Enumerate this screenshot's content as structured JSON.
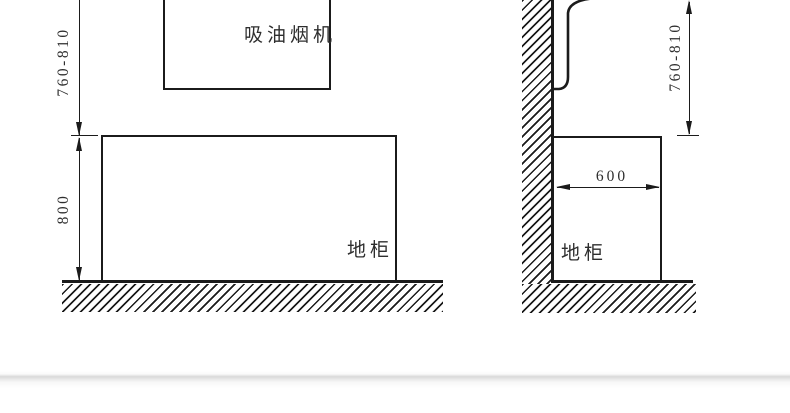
{
  "page": {
    "background_color": "#ffffff",
    "has_bottom_shadow_divider": true
  },
  "diagram": {
    "type": "installation-dimension-diagram",
    "line_color": "#1b1b1b",
    "text_color": "#2e2e2e",
    "front_view": {
      "hood_label": "吸油烟机",
      "cabinet_label": "地柜",
      "dim_hood_to_counter": "760-810",
      "dim_cabinet_height": "800"
    },
    "side_view": {
      "cabinet_label": "地柜",
      "dim_hood_to_counter": "760-810",
      "dim_cabinet_depth": "600"
    }
  }
}
